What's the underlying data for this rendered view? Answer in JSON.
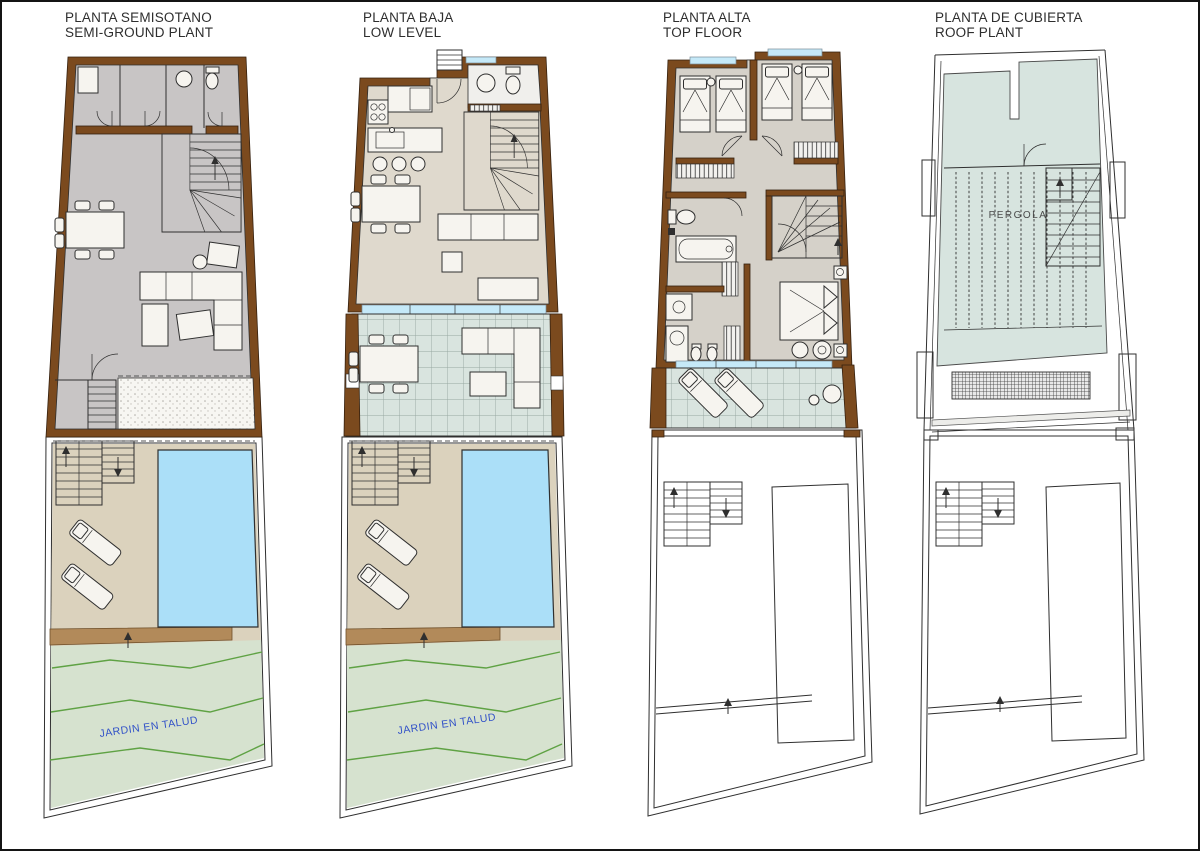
{
  "sheet": {
    "background": "#FFFFFF",
    "border_color": "#141414"
  },
  "plans": [
    {
      "id": "semi-ground",
      "title_line1": "PLANTA SEMISOTANO",
      "title_line2": "SEMI-GROUND PLANT",
      "garden_label": "JARDIN EN TALUD"
    },
    {
      "id": "low-level",
      "title_line1": "PLANTA BAJA",
      "title_line2": "LOW LEVEL",
      "garden_label": "JARDIN EN TALUD"
    },
    {
      "id": "top-floor",
      "title_line1": "PLANTA ALTA",
      "title_line2": "TOP FLOOR"
    },
    {
      "id": "roof",
      "title_line1": "PLANTA DE CUBIERTA",
      "title_line2": "ROOF PLANT",
      "roof_label": "PERGOLA"
    }
  ],
  "colors": {
    "outline": "#2F2F2F",
    "wall_brown": "#7B4A1E",
    "floor_gray": "#C8C5C5",
    "floor_beige": "#DFD9CD",
    "bedroom_floor": "#D5D1C9",
    "room_white": "#F0EFEC",
    "terrace_fill": "#D9E4DF",
    "window_blue": "#C5E9F8",
    "pool_blue": "#ABDFF8",
    "sand": "#DBD2BD",
    "strip_tan": "#B28A5A",
    "slope_green": "#D6E2CF",
    "contour_green": "#5FA244",
    "label_blue": "#3050C8",
    "roof_fill": "#D7E4DF",
    "title_text": "#2E2E2E"
  }
}
